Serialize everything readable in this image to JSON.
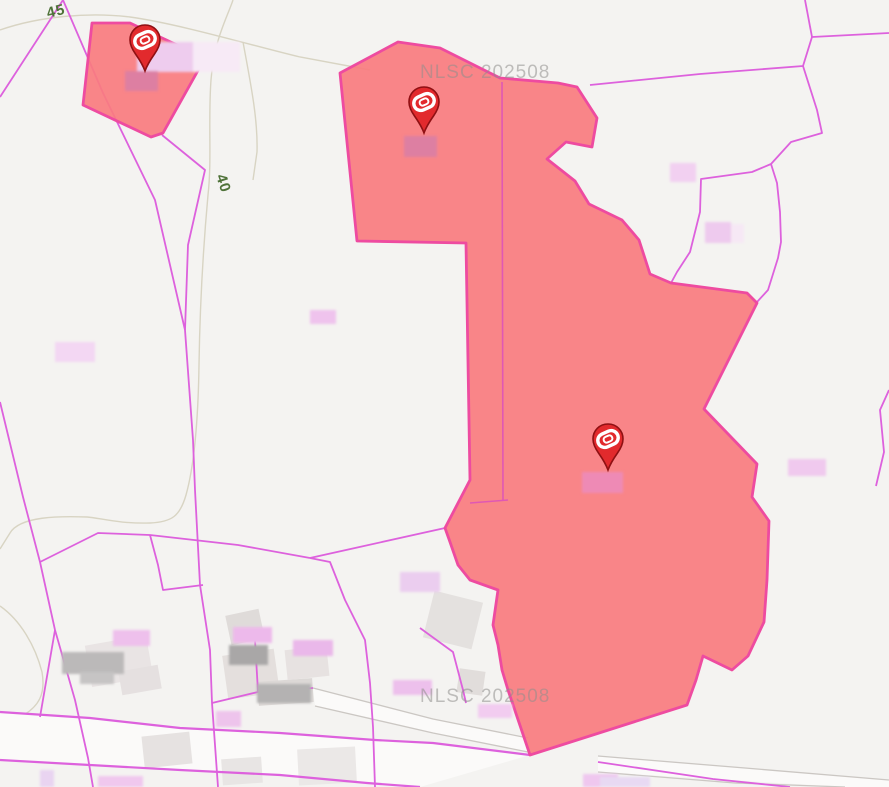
{
  "app": {
    "type": "cadastral-map-viewer"
  },
  "watermarks": [
    {
      "text": "NLSC 202508"
    },
    {
      "text": "NLSC 202508"
    }
  ],
  "contour_labels": [
    {
      "text": "45"
    },
    {
      "text": "40"
    }
  ],
  "markers": [
    {
      "id": "marker-1",
      "transform": "translate(145,71)"
    },
    {
      "id": "marker-2",
      "transform": "translate(424,133)"
    },
    {
      "id": "marker-3",
      "transform": "translate(608,470)"
    }
  ],
  "highlighted_parcel_count": 3,
  "colors": {
    "background": "#f4f3f1",
    "parcel_line_magenta": "#dd61dd",
    "highlight_fill": "#f97c7f",
    "highlight_border": "#ee4ba0",
    "marker_red": "#e22a2d",
    "marker_outline": "#8f1013",
    "watermark_gray": "#8f8e8c",
    "contour_label_green": "#4f7239",
    "contour_line_tan": "#d8d4c3",
    "building_gray": "#e4e0de",
    "road_fill": "#fbfaf9",
    "road_border_gray": "#cbc7c3",
    "redaction_pink": "#efc7ef",
    "redaction_rose_on_red": "#dd7fa2",
    "redaction_gray": "#b5b3b3"
  }
}
